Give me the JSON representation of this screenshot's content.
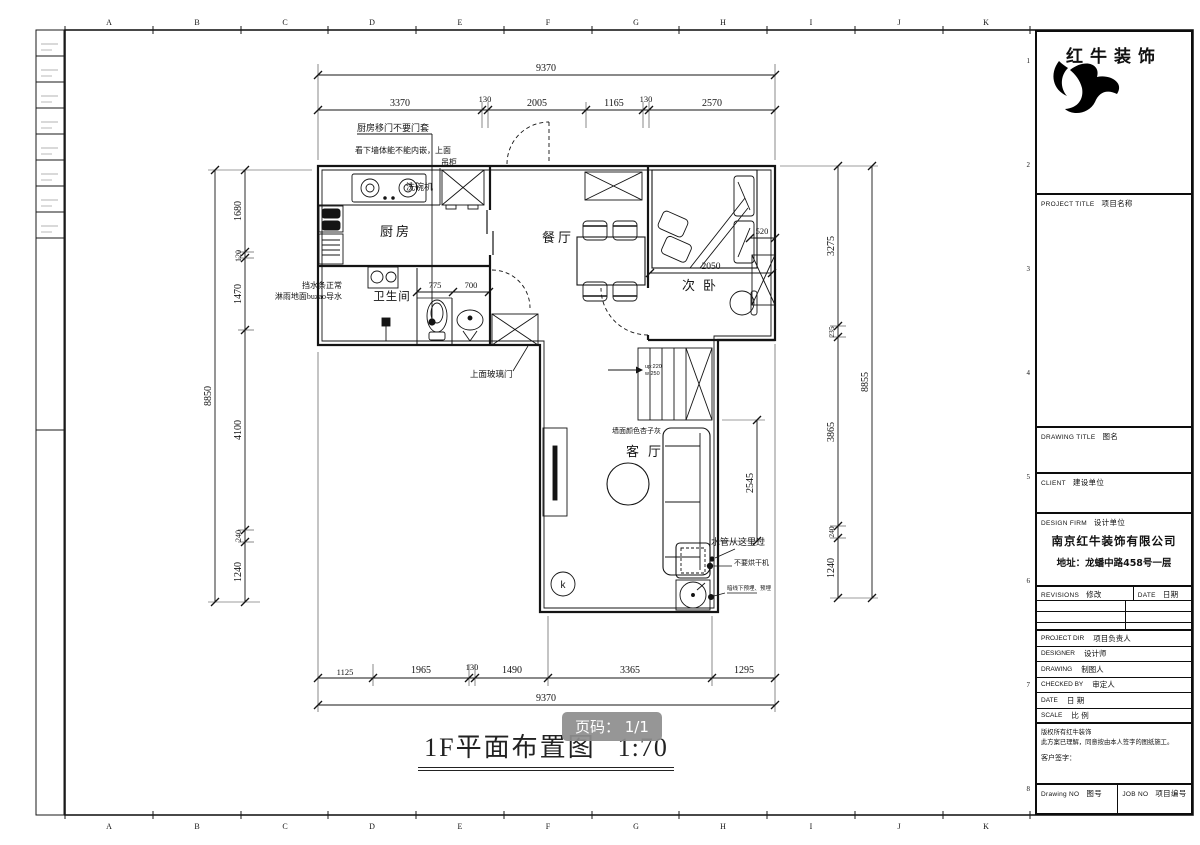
{
  "sheet": {
    "page_badge": "页码： 1/1",
    "title": "1F平面布置图",
    "scale": "1:70"
  },
  "frame": {
    "cols": [
      "A",
      "B",
      "C",
      "D",
      "E",
      "F",
      "G",
      "H",
      "I",
      "J",
      "K"
    ],
    "rows": [
      "1",
      "2",
      "3",
      "4",
      "5",
      "6",
      "7",
      "8"
    ]
  },
  "title_block": {
    "company": "红牛装饰",
    "project_title_label": "PROJECT TITLE",
    "project_title_cn": "项目名称",
    "drawing_title_label": "DRAWING TITLE",
    "drawing_title_cn": "图名",
    "client_label": "CLIENT",
    "client_cn": "建设单位",
    "design_firm_label": "DESIGN FIRM",
    "design_firm_cn": "设计单位",
    "firm_name": "南京红牛装饰有限公司",
    "firm_address": "地址：龙蟠中路458号一层",
    "revisions_label": "REVISIONS",
    "revisions_cn": "修改",
    "date_col_label": "DATE",
    "date_col_cn": "日期",
    "project_dir_label": "PROJECT DIR",
    "project_dir_cn": "项目负责人",
    "designer_label": "DESIGNER",
    "designer_cn": "设计师",
    "drawing_label": "DRAWING",
    "drawing_cn": "制图人",
    "checked_label": "CHECKED BY",
    "checked_cn": "审定人",
    "date_label": "DATE",
    "date_cn": "日 期",
    "scale_label": "SCALE",
    "scale_cn": "比 例",
    "copyright_line1": "版权所有红牛装饰",
    "copyright_line2": "此方案已理解，同意按由本人签字的图纸施工。",
    "signature_label": "客户签字：",
    "drawing_no_label": "Drawing NO",
    "drawing_no_cn": "图号",
    "job_no_label": "JOB NO",
    "job_no_cn": "项目编号"
  },
  "rooms": {
    "kitchen": "厨房",
    "dining": "餐厅",
    "bedroom": "次卧",
    "bathroom": "卫生间",
    "living": "客厅"
  },
  "annotations": {
    "kitchen_door_note": "厨房移门不要门套",
    "niche_note_1": "看下墙体能不能内嵌，上面",
    "niche_note_2": "吊柜",
    "dishwasher": "洗碗机",
    "water_strip": "挡水条正常",
    "shower_floor": "淋雨地面buzao导水",
    "glass_door": "上面玻璃门",
    "wall_color": "墙面颜色杏子灰",
    "water_pipe": "水管从这里过",
    "no_dryer": "不要烘干机",
    "conceal_note": "暗线下预埋、预埋",
    "stair_up": "up:220",
    "stair_w": "w:250",
    "k_mark": "k"
  },
  "dims": {
    "top_total": "9370",
    "top": [
      "3370",
      "130",
      "2005",
      "1165",
      "130",
      "2570"
    ],
    "bottom": [
      "1125",
      "1965",
      "130",
      "1490",
      "3365",
      "1295"
    ],
    "bottom_total": "9370",
    "left_total": "8850",
    "left": [
      "1680",
      "120",
      "1470",
      "4100",
      "240",
      "1240"
    ],
    "right_total": "8855",
    "right": [
      "3275",
      "235",
      "3865",
      "240",
      "1240"
    ],
    "bath": [
      "775",
      "700"
    ],
    "bed": "2050",
    "wardrobe": "520",
    "living_right": "2545"
  }
}
